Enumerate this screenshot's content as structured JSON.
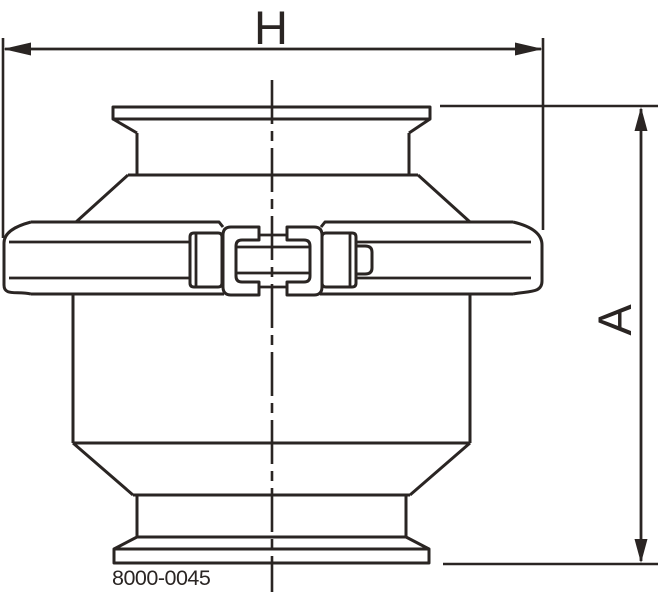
{
  "drawing": {
    "part_number": "8000-0045",
    "dimension_labels": {
      "horizontal": "H",
      "vertical": "A"
    },
    "colors": {
      "line": "#2a2523",
      "background": "#ffffff"
    }
  }
}
